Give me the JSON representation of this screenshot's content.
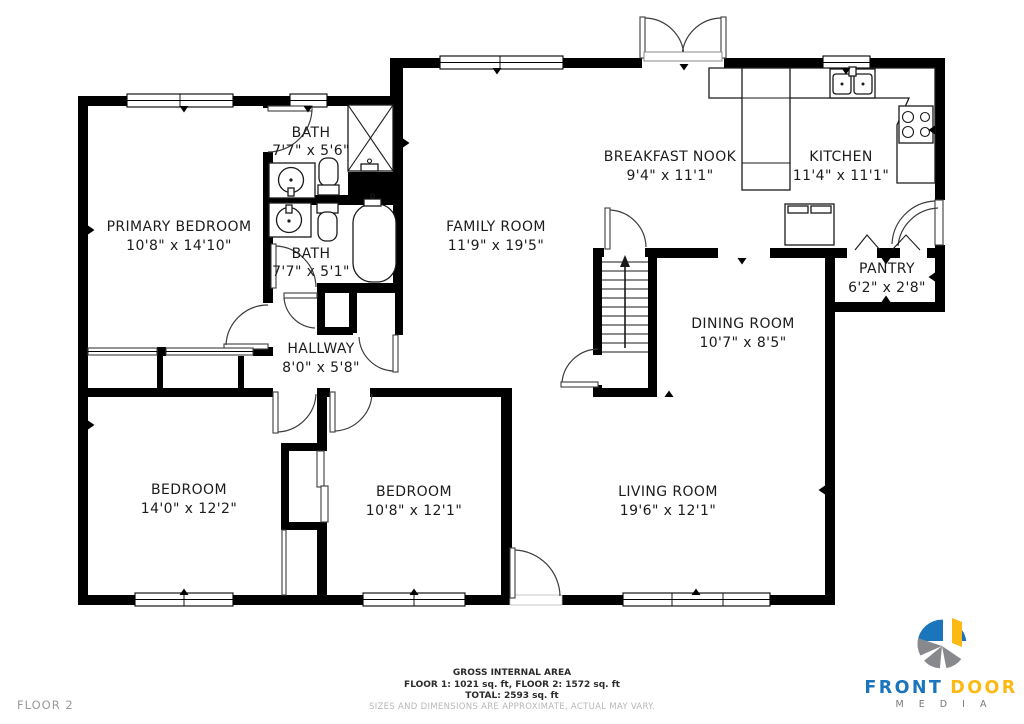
{
  "floor_label": "FLOOR 2",
  "rooms": {
    "primary_bedroom": {
      "name": "PRIMARY BEDROOM",
      "dims": "10'8\" x 14'10\""
    },
    "bath_upper": {
      "name": "BATH",
      "dims": "7'7\" x 5'6\""
    },
    "bath_lower": {
      "name": "BATH",
      "dims": "7'7\" x 5'1\""
    },
    "hallway": {
      "name": "HALLWAY",
      "dims": "8'0\" x 5'8\""
    },
    "family_room": {
      "name": "FAMILY ROOM",
      "dims": "11'9\" x 19'5\""
    },
    "breakfast_nook": {
      "name": "BREAKFAST NOOK",
      "dims": "9'4\" x 11'1\""
    },
    "kitchen": {
      "name": "KITCHEN",
      "dims": "11'4\" x 11'1\""
    },
    "pantry": {
      "name": "PANTRY",
      "dims": "6'2\" x 2'8\""
    },
    "dining_room": {
      "name": "DINING ROOM",
      "dims": "10'7\" x 8'5\""
    },
    "bedroom_left": {
      "name": "BEDROOM",
      "dims": "14'0\" x 12'2\""
    },
    "bedroom_middle": {
      "name": "BEDROOM",
      "dims": "10'8\" x 12'1\""
    },
    "living_room": {
      "name": "LIVING ROOM",
      "dims": "19'6\" x 12'1\""
    }
  },
  "footer": {
    "title": "GROSS INTERNAL AREA",
    "line1": "FLOOR 1: 1021 sq. ft, FLOOR 2: 1572 sq. ft",
    "line2": "TOTAL: 2593 sq. ft",
    "disclaimer": "SIZES AND DIMENSIONS ARE APPROXIMATE, ACTUAL MAY VARY."
  },
  "logo": {
    "brand_front": "FRONT",
    "brand_door": "DOOR",
    "media": "M E D I A",
    "colors": {
      "blue": "#1b75bc",
      "yellow": "#fdb913",
      "gray": "#87898c"
    }
  }
}
